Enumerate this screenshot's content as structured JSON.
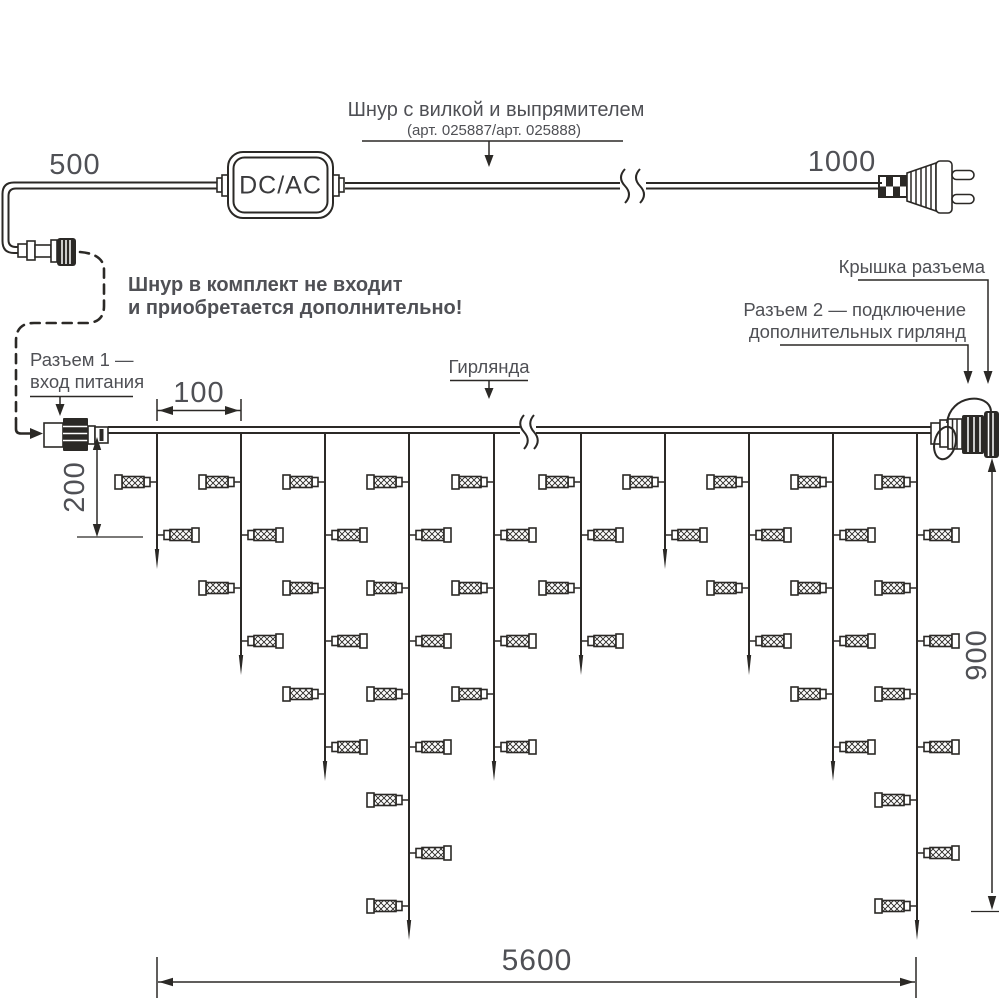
{
  "labels": {
    "dim_cord_left": "500",
    "dim_cord_right": "1000",
    "cord_title": "Шнур с вилкой и выпрямителем",
    "cord_article": "(арт. 025887/арт. 025888)",
    "converter": "DC/AC",
    "note_line1": "Шнур в комплект не входит",
    "note_line2": "и приобретается дополнительно!",
    "connector1_line1": "Разъем 1 —",
    "connector1_line2": "вход питания",
    "cap_label": "Крышка разъема",
    "connector2_line1": "Разъем 2 — подключение",
    "connector2_line2": "дополнительных гирлянд",
    "garland_label": "Гирлянда",
    "dim_drop_spacing": "100",
    "dim_first_lamp": "200",
    "dim_height": "900",
    "dim_length": "5600"
  },
  "colors": {
    "line": "#2b2926",
    "text": "#4f5055",
    "background": "#ffffff"
  },
  "garland": {
    "wire_y_top": 427,
    "wire_y_bottom": 433,
    "wire_x_start": 108,
    "wire_x_end": 931,
    "break_x": 528,
    "lamp_first_y": 482,
    "lamp_spacing": 53,
    "lamp_total": 52,
    "drops": [
      {
        "x": 157,
        "lamps": 2
      },
      {
        "x": 241,
        "lamps": 4
      },
      {
        "x": 325,
        "lamps": 6
      },
      {
        "x": 409,
        "lamps": 9
      },
      {
        "x": 494,
        "lamps": 6
      },
      {
        "x": 581,
        "lamps": 4
      },
      {
        "x": 665,
        "lamps": 2
      },
      {
        "x": 749,
        "lamps": 4
      },
      {
        "x": 833,
        "lamps": 6
      },
      {
        "x": 917,
        "lamps": 9
      }
    ]
  }
}
